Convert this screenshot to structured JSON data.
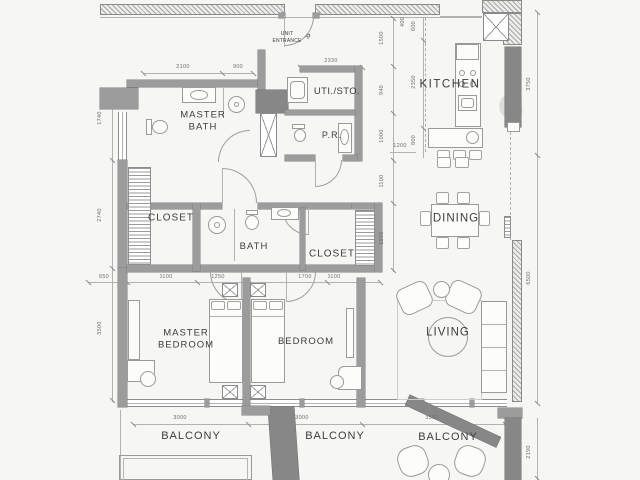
{
  "plan": {
    "rooms": {
      "master_bath": "MASTER\nBATH",
      "uti_sto": "UTI./STO.",
      "pr": "P.R.",
      "kitchen": "KITCHEN",
      "closet_1": "CLOSET",
      "bath": "BATH",
      "closet_2": "CLOSET",
      "dining": "DINING",
      "master_bedroom": "MASTER\nBEDROOM",
      "bedroom": "BEDROOM",
      "living": "LIVING",
      "balcony_1": "BALCONY",
      "balcony_2": "BALCONY",
      "balcony_3": "BALCONY",
      "unit_entrance": "UNIT\nENTRANCE"
    },
    "dimensions": {
      "top": {
        "a": "2100",
        "b": "900",
        "c": "2330"
      },
      "left": {
        "a": "1740",
        "b": "2740",
        "c": "3500"
      },
      "inner": {
        "a": "1500",
        "b": "940",
        "c": "1000",
        "d": "1100",
        "e": "1500"
      },
      "kitchen_chain": {
        "a": "400",
        "b": "600",
        "c": "2350",
        "d": "800",
        "e": "1200"
      },
      "right": {
        "a": "3750",
        "b": "6500",
        "c": "2190"
      },
      "middle": {
        "a": "650",
        "b": "1100",
        "c": "1250",
        "d": "1700",
        "e": "1100"
      },
      "bottom": {
        "a": "3000",
        "b": "3000",
        "c": "3500"
      }
    },
    "icons": {
      "entrance_arrow": "»"
    },
    "watermark": "G",
    "colors": {
      "wall": "#9c9c9c",
      "wall_dark": "#878787",
      "line": "#9a9a9a",
      "text": "#3d3d3d"
    }
  }
}
